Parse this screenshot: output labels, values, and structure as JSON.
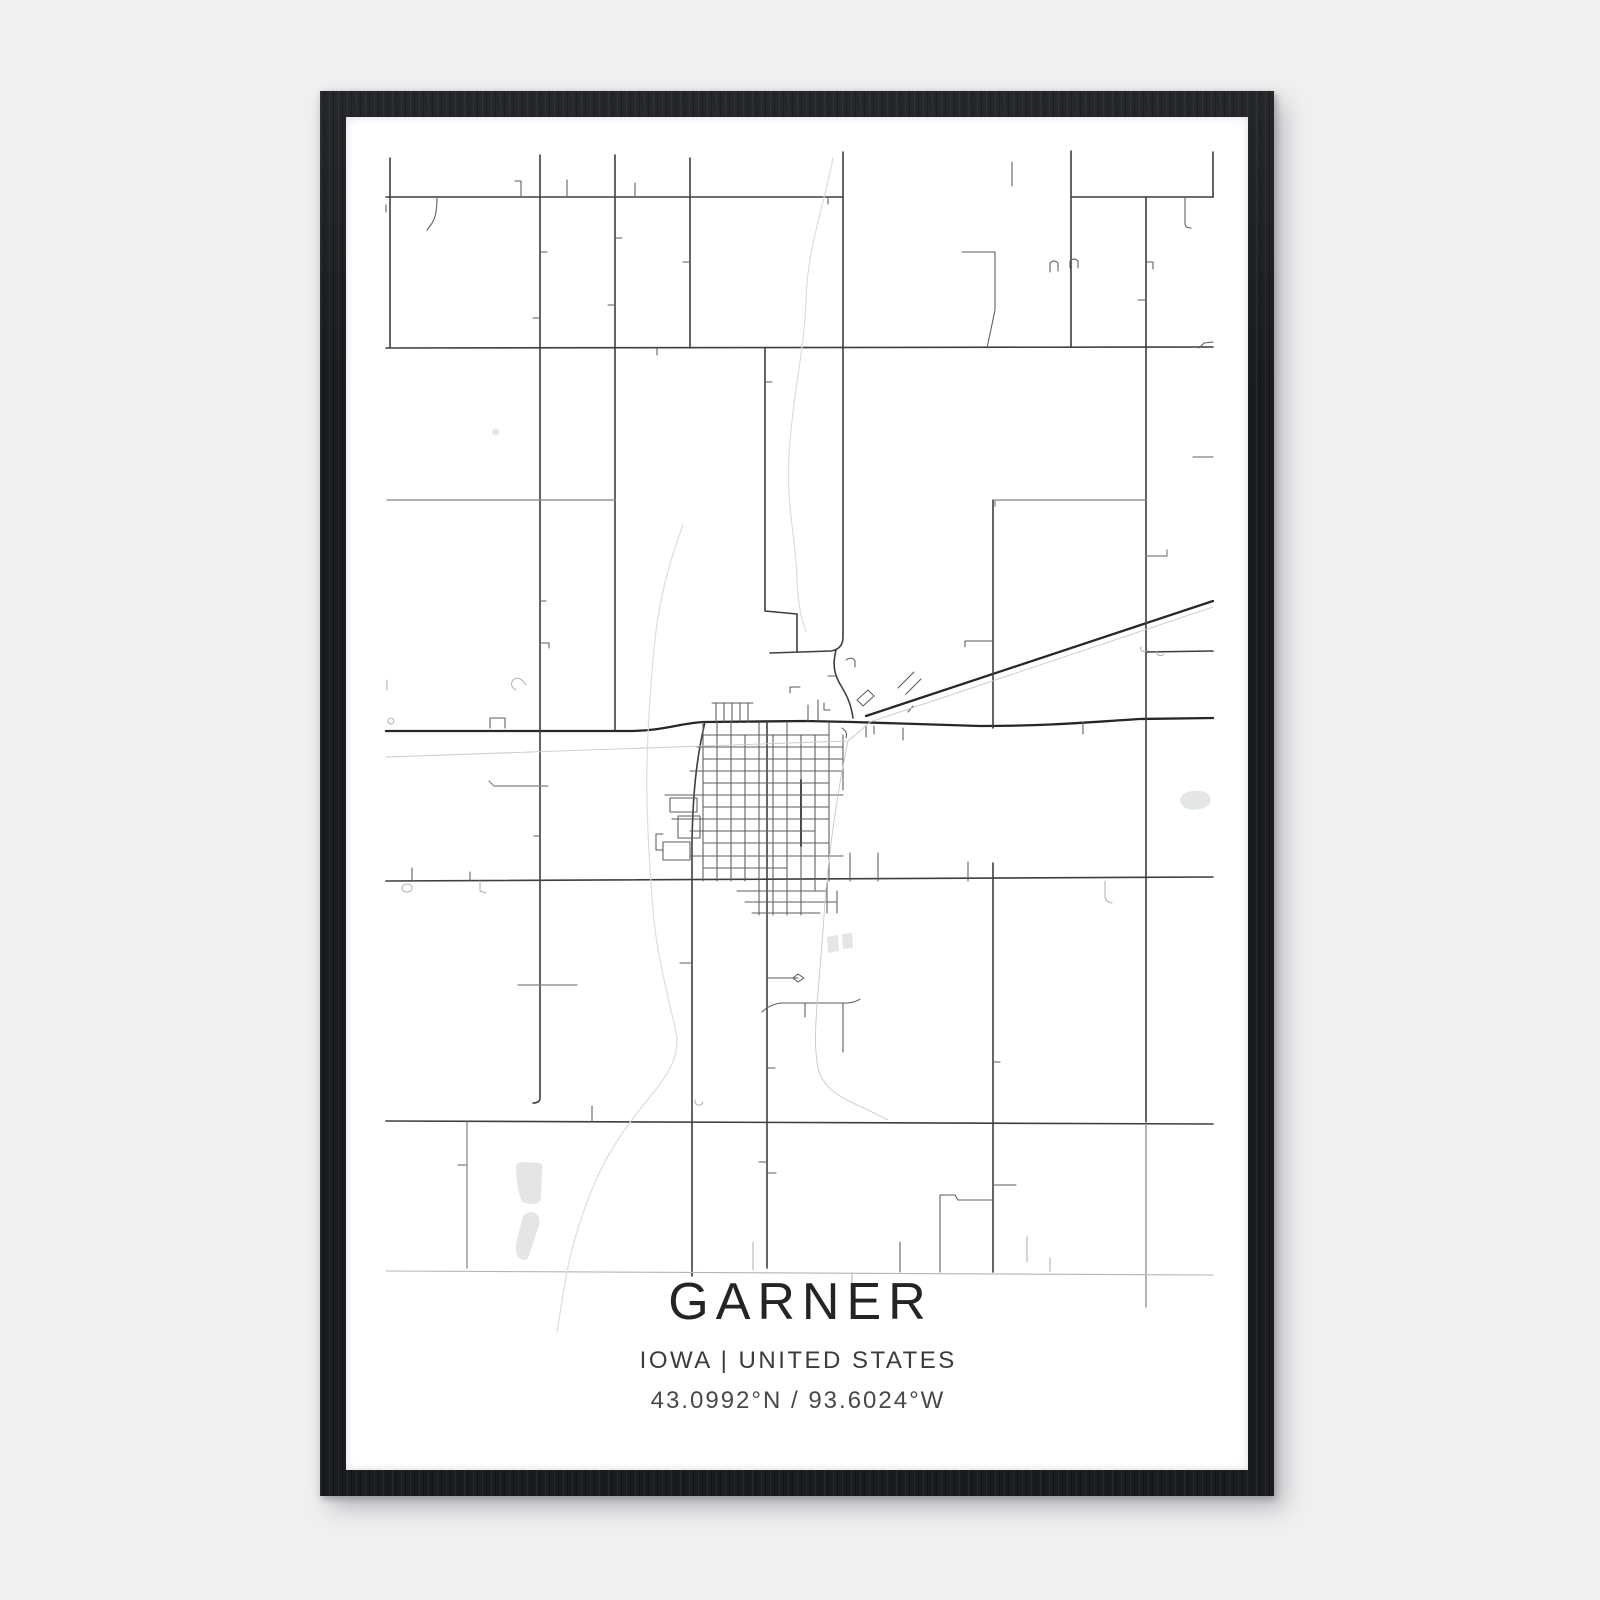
{
  "poster": {
    "title": "GARNER",
    "location": "IOWA | UNITED STATES",
    "coordinates": "43.0992°N / 93.6024°W"
  },
  "colors": {
    "page_bg": "#f0f0f1",
    "frame": "#1a1c1f",
    "poster_bg": "#ffffff",
    "title_text": "#232426",
    "subtitle_text": "#3a3b3d",
    "coords_text": "#474849"
  },
  "map": {
    "viewBox": "346 117 902 1353",
    "groups": [
      {
        "name": "highway-roads",
        "color": "#26272a",
        "width": 2.3,
        "paths": [
          "M386,731 L628,731 C664,731 680,723 704,722 L806,721 L852,722 L980,726 C1050,726 1090,722 1140,719 L1213,718",
          "M866,716 L1213,601"
        ]
      },
      {
        "name": "primary-roads",
        "color": "#3d3e42",
        "width": 1.6,
        "paths": [
          "M386,197 L843,197",
          "M1072,197 L1213,197",
          "M386,348 L1213,347",
          "M386,881 L1213,877",
          "M386,1121 L1213,1124",
          "M390,158 L390,347",
          "M540,155 L540,1098 Q540,1103 533,1103",
          "M615,155 L615,730",
          "M690,158 L690,348",
          "M843,152 L843,637 Q843,649 831,651 L770,653",
          "M765,348 L765,611 L797,614 L797,652",
          "M1071,151 L1071,347",
          "M1146,197 L1146,1122",
          "M1213,152 L1213,197",
          "M1146,652 L1213,651",
          "M993,500 L993,728",
          "M993,863 L993,1272",
          "M705,722 C696,760 693,795 692,840 L692,1276",
          "M767,722 L767,1268",
          "M836,650 C833,662 833,672 840,684 C846,694 851,703 853,718"
        ]
      },
      {
        "name": "town-main-dark",
        "color": "#232427",
        "width": 1.9,
        "paths": [
          "M801,780 L801,846"
        ]
      },
      {
        "name": "minor-roads",
        "color": "#5a5b5f",
        "width": 1.05,
        "paths": [
          "M703,722 L703,881",
          "M717,722 L717,881",
          "M731,722 L731,881",
          "M745,735 L745,881",
          "M759,722 L759,915",
          "M773,735 L773,915",
          "M787,722 L787,915",
          "M801,735 L801,915",
          "M815,735 L815,890",
          "M829,722 L829,881",
          "M843,735 L843,790",
          "M703,735 L829,735",
          "M697,747 L843,747",
          "M703,759 L843,759",
          "M690,771 L843,771",
          "M703,783 L829,783",
          "M665,795 L843,795",
          "M703,807 L829,807",
          "M672,819 L829,819",
          "M690,831 L815,831",
          "M703,843 L829,843",
          "M690,856 L843,856",
          "M703,868 L787,868",
          "M737,891 L827,891",
          "M745,902 L837,902",
          "M752,913 L820,913",
          "M827,881 L827,913",
          "M837,891 L837,913",
          "M850,853 L850,881",
          "M878,853 L878,881",
          "M968,862 L968,881",
          "M712,703 L753,703",
          "M716,703 L716,722",
          "M724,703 L724,722",
          "M732,703 L732,722",
          "M740,703 L740,722",
          "M748,703 L748,722",
          "M808,705 L808,721",
          "M818,700 L818,721",
          "M824,703 L824,710 L830,710",
          "M670,798 L697,798 L697,812 L670,812 Z",
          "M678,816 L700,816 L700,838 L678,838 Z",
          "M663,842 L690,842 L690,860 L663,860 Z",
          "M663,850 L656,850 L656,834 L663,834",
          "M962,252 L995,252 L995,310 L987,348",
          "M965,641 L993,641 M965,641 L965,647",
          "M762,1012 Q770,1004 782,1003 L848,1003 Q856,1002 860,999",
          "M843,1003 L843,1052",
          "M805,1003 L805,1017",
          "M767,978 L798,978 M798,974 L804,978 L798,982 L793,978 Z",
          "M790,693 L790,687 L800,687",
          "M857,700 L868,690 L874,696 L863,706 Z",
          "M846,660 Q852,656 855,661 L855,667",
          "M836,676 L828,676",
          "M866,726 L866,737",
          "M874,726 L874,734",
          "M842,728 Q848,732 846,738",
          "M898,688 L914,672",
          "M906,694 L921,679",
          "M908,712 L913,706",
          "M903,728 L903,740",
          "M1083,722 L1083,734",
          "M657,348 L657,355",
          "M540,252 L547,252",
          "M533,318 L540,318",
          "M540,601 L546,601",
          "M540,643 L549,643 L549,648",
          "M534,836 L540,836",
          "M615,238 L622,238",
          "M608,305 L615,305",
          "M683,262 L690,262",
          "M765,382 L772,382",
          "M521,181 L521,197 M515,181 L521,181",
          "M567,180 L567,197",
          "M635,183 L635,197",
          "M828,197 L828,204",
          "M437,197 C437,212 435,220 430,226 L427,230",
          "M1185,197 L1185,223 Q1185,228 1191,228",
          "M1012,162 L1012,186",
          "M1050,272 L1050,263 Q1054,259 1058,263 L1058,271",
          "M1070,268 L1070,261 Q1074,257 1078,261 L1078,268",
          "M1199,348 L1204,343 L1213,342",
          "M1146,262 L1153,262 L1153,269",
          "M1138,300 L1146,300",
          "M490,718 L490,728 M490,718 L505,718 L505,728",
          "M592,1106 L592,1122",
          "M767,1068 L775,1068",
          "M759,1162 L767,1162 M767,1173 L776,1173",
          "M680,963 L692,963",
          "M993,1062 L1000,1062",
          "M993,1185 L1016,1185",
          "M993,1200 L958,1200 L955,1195 L940,1195 L940,1272",
          "M900,1242 L900,1272",
          "M470,872 L470,881",
          "M412,868 L412,881",
          "M386,205 L386,212"
        ]
      },
      {
        "name": "secondary-roads",
        "color": "#808184",
        "width": 1.2,
        "paths": [
          "M387,500 L615,500",
          "M995,500 L1146,500 M995,500 L995,506",
          "M489,781 L494,786 L548,786",
          "M518,985 L577,985",
          "M467,1122 L467,1268 M458,1165 L467,1165",
          "M1146,1122 L1146,1307",
          "M1193,457 L1213,457",
          "M1146,556 L1167,556 L1167,550"
        ]
      },
      {
        "name": "light-details",
        "color": "#aeafb2",
        "width": 1.0,
        "paths": [
          "M388,721 a3,3 0 1 0 6,0 a3,3 0 1 0 -6,0",
          "M402,888 a5,4 0 1 0 10,0 a5,4 0 1 0 -10,0",
          "M480,881 L480,891 L486,893",
          "M387,680 L387,690",
          "M1141,647 a4,3 0 1 0 7,3",
          "M1157,651 a4,3 0 1 0 7,3",
          "M695,1100 a4,4 0 1 0 8,2",
          "M516,690 Q509,686 513,680 Q518,676 523,681 L526,685",
          "M1050,1258 L1050,1272",
          "M852,1273 L852,1308",
          "M1027,1236 L1027,1262",
          "M753,1242 L753,1270",
          "M1105,881 L1105,896 Q1105,902 1112,903"
        ]
      },
      {
        "name": "bottom-faint-road",
        "color": "#b4b5b8",
        "width": 1.1,
        "paths": [
          "M386,1271 L1213,1275"
        ]
      },
      {
        "name": "railroad",
        "color": "#c8c9cb",
        "width": 0.9,
        "paths": [
          "M1213,607 L870,722 Q858,733 848,741 L386,757",
          "M848,741 C838,790 828,850 823,930 C818,1000 812,1038 818,1068 C823,1090 845,1100 866,1109 L888,1120"
        ]
      },
      {
        "name": "streams",
        "color": "#dcdddf",
        "width": 1.2,
        "paths": [
          "M833,158 C824,205 807,250 806,300 C805,345 792,400 789,455 C786,505 796,540 797,578 C798,604 801,618 806,632",
          "M683,525 C669,562 658,602 654,650 C650,692 648,722 647,762 C646,802 649,860 653,910 C656,950 667,992 676,1032 C681,1056 667,1076 649,1098 C629,1122 609,1150 596,1180 C584,1208 571,1245 565,1283 C561,1306 559,1320 557,1332"
        ]
      }
    ],
    "water": {
      "name": "ponds",
      "color": "#e4e5e7",
      "paths": [
        "M1180,802 Q1180,793 1192,791 Q1206,789 1210,797 Q1213,806 1200,809 Q1185,812 1180,802 Z",
        "M516,1166 Q516,1162 524,1162 L540,1163 Q543,1164 542,1170 L541,1198 Q540,1205 531,1204 L522,1202 Q516,1186 516,1166 Z",
        "M523,1216 Q532,1208 538,1216 Q541,1220 538,1228 L529,1256 Q526,1263 519,1258 Q514,1252 517,1240 Z",
        "M827,937 L838,935 L839,951 L828,953 Z",
        "M842,934 L852,933 L853,948 L843,949 Z",
        "M492,432 a3.5,3.5 0 1 0 7,0 a3.5,3.5 0 1 0 -7,0"
      ]
    }
  }
}
